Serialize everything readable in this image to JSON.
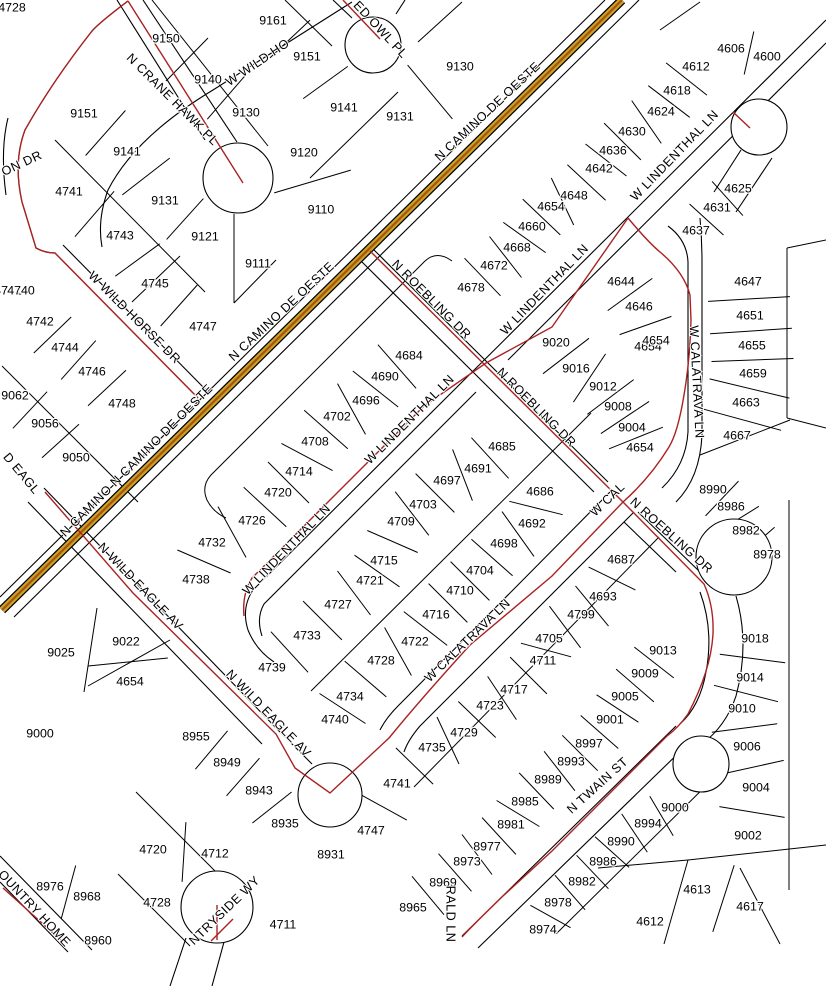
{
  "map": {
    "background": "#ffffff",
    "colors": {
      "parcel_line": "#000000",
      "subdivision_boundary": "#aa2222",
      "highway_outer": "#c9a227",
      "highway_core": "#a85410",
      "label_text": "#000000"
    },
    "highway_name": "N CAMINO DE OESTE",
    "parcel_labels": [
      {
        "t": "4728",
        "x": 12,
        "y": 8
      },
      {
        "t": "9161",
        "x": 273,
        "y": 21
      },
      {
        "t": "9150",
        "x": 166,
        "y": 39
      },
      {
        "t": "9151",
        "x": 307,
        "y": 57
      },
      {
        "t": "9140",
        "x": 208,
        "y": 80
      },
      {
        "t": "9130",
        "x": 460,
        "y": 67
      },
      {
        "t": "9151",
        "x": 84,
        "y": 114
      },
      {
        "t": "9141",
        "x": 344,
        "y": 108
      },
      {
        "t": "9130",
        "x": 246,
        "y": 113
      },
      {
        "t": "9131",
        "x": 400,
        "y": 117
      },
      {
        "t": "9141",
        "x": 127,
        "y": 152
      },
      {
        "t": "9120",
        "x": 304,
        "y": 153
      },
      {
        "t": "4741",
        "x": 69,
        "y": 192
      },
      {
        "t": "9131",
        "x": 165,
        "y": 201
      },
      {
        "t": "9110",
        "x": 321,
        "y": 210
      },
      {
        "t": "9121",
        "x": 205,
        "y": 237
      },
      {
        "t": "4743",
        "x": 120,
        "y": 236
      },
      {
        "t": "9111",
        "x": 258,
        "y": 264
      },
      {
        "t": "4745",
        "x": 155,
        "y": 284
      },
      {
        "t": "4747",
        "x": 203,
        "y": 327
      },
      {
        "t": "4741",
        "x": 8,
        "y": 291
      },
      {
        "t": "4740",
        "x": 21,
        "y": 291
      },
      {
        "t": "4742",
        "x": 40,
        "y": 322
      },
      {
        "t": "4744",
        "x": 65,
        "y": 348
      },
      {
        "t": "4746",
        "x": 92,
        "y": 372
      },
      {
        "t": "4748",
        "x": 122,
        "y": 404
      },
      {
        "t": "9062",
        "x": 15,
        "y": 396
      },
      {
        "t": "9056",
        "x": 45,
        "y": 424
      },
      {
        "t": "9050",
        "x": 76,
        "y": 458
      },
      {
        "t": "4606",
        "x": 731,
        "y": 49
      },
      {
        "t": "4600",
        "x": 767,
        "y": 57
      },
      {
        "t": "4612",
        "x": 696,
        "y": 67
      },
      {
        "t": "4618",
        "x": 677,
        "y": 91
      },
      {
        "t": "4624",
        "x": 661,
        "y": 112
      },
      {
        "t": "4630",
        "x": 632,
        "y": 132
      },
      {
        "t": "4636",
        "x": 613,
        "y": 151
      },
      {
        "t": "4642",
        "x": 599,
        "y": 169
      },
      {
        "t": "4648",
        "x": 574,
        "y": 196
      },
      {
        "t": "4654",
        "x": 551,
        "y": 207
      },
      {
        "t": "4660",
        "x": 532,
        "y": 227
      },
      {
        "t": "4668",
        "x": 517,
        "y": 248
      },
      {
        "t": "4672",
        "x": 494,
        "y": 266
      },
      {
        "t": "4678",
        "x": 471,
        "y": 288
      },
      {
        "t": "4625",
        "x": 738,
        "y": 189
      },
      {
        "t": "4631",
        "x": 717,
        "y": 208
      },
      {
        "t": "4637",
        "x": 696,
        "y": 231
      },
      {
        "t": "4644",
        "x": 621,
        "y": 282
      },
      {
        "t": "4646",
        "x": 639,
        "y": 307
      },
      {
        "t": "4654",
        "x": 648,
        "y": 347
      },
      {
        "t": "4654",
        "x": 656,
        "y": 341
      },
      {
        "t": "9020",
        "x": 556,
        "y": 343
      },
      {
        "t": "9016",
        "x": 576,
        "y": 369
      },
      {
        "t": "9012",
        "x": 603,
        "y": 387
      },
      {
        "t": "9008",
        "x": 618,
        "y": 407
      },
      {
        "t": "9004",
        "x": 632,
        "y": 428
      },
      {
        "t": "4654",
        "x": 640,
        "y": 448
      },
      {
        "t": "4647",
        "x": 748,
        "y": 282
      },
      {
        "t": "4651",
        "x": 750,
        "y": 316
      },
      {
        "t": "4655",
        "x": 752,
        "y": 346
      },
      {
        "t": "4659",
        "x": 753,
        "y": 374
      },
      {
        "t": "4663",
        "x": 746,
        "y": 403
      },
      {
        "t": "4667",
        "x": 737,
        "y": 436
      },
      {
        "t": "8990",
        "x": 713,
        "y": 490
      },
      {
        "t": "8986",
        "x": 731,
        "y": 507
      },
      {
        "t": "8982",
        "x": 746,
        "y": 531
      },
      {
        "t": "8978",
        "x": 767,
        "y": 555
      },
      {
        "t": "4684",
        "x": 409,
        "y": 356
      },
      {
        "t": "4690",
        "x": 385,
        "y": 377
      },
      {
        "t": "4696",
        "x": 366,
        "y": 401
      },
      {
        "t": "4702",
        "x": 337,
        "y": 417
      },
      {
        "t": "4708",
        "x": 315,
        "y": 442
      },
      {
        "t": "4714",
        "x": 299,
        "y": 472
      },
      {
        "t": "4720",
        "x": 278,
        "y": 493
      },
      {
        "t": "4726",
        "x": 252,
        "y": 521
      },
      {
        "t": "4732",
        "x": 212,
        "y": 543
      },
      {
        "t": "4738",
        "x": 196,
        "y": 580
      },
      {
        "t": "4685",
        "x": 502,
        "y": 447
      },
      {
        "t": "4691",
        "x": 478,
        "y": 469
      },
      {
        "t": "4697",
        "x": 447,
        "y": 481
      },
      {
        "t": "4703",
        "x": 423,
        "y": 505
      },
      {
        "t": "4709",
        "x": 401,
        "y": 522
      },
      {
        "t": "4715",
        "x": 384,
        "y": 561
      },
      {
        "t": "4721",
        "x": 370,
        "y": 581
      },
      {
        "t": "4727",
        "x": 338,
        "y": 605
      },
      {
        "t": "4733",
        "x": 307,
        "y": 636
      },
      {
        "t": "4739",
        "x": 272,
        "y": 668
      },
      {
        "t": "4686",
        "x": 540,
        "y": 492
      },
      {
        "t": "4692",
        "x": 532,
        "y": 524
      },
      {
        "t": "4698",
        "x": 504,
        "y": 544
      },
      {
        "t": "4704",
        "x": 480,
        "y": 571
      },
      {
        "t": "4710",
        "x": 460,
        "y": 591
      },
      {
        "t": "4716",
        "x": 436,
        "y": 615
      },
      {
        "t": "4722",
        "x": 415,
        "y": 642
      },
      {
        "t": "4728",
        "x": 381,
        "y": 661
      },
      {
        "t": "4734",
        "x": 350,
        "y": 697
      },
      {
        "t": "4740",
        "x": 335,
        "y": 720
      },
      {
        "t": "9025",
        "x": 61,
        "y": 653
      },
      {
        "t": "9022",
        "x": 126,
        "y": 642
      },
      {
        "t": "4654",
        "x": 130,
        "y": 682
      },
      {
        "t": "9000",
        "x": 40,
        "y": 734
      },
      {
        "t": "8955",
        "x": 196,
        "y": 737
      },
      {
        "t": "8949",
        "x": 227,
        "y": 763
      },
      {
        "t": "8943",
        "x": 259,
        "y": 791
      },
      {
        "t": "8935",
        "x": 285,
        "y": 824
      },
      {
        "t": "8931",
        "x": 331,
        "y": 855
      },
      {
        "t": "4720",
        "x": 153,
        "y": 850
      },
      {
        "t": "4712",
        "x": 215,
        "y": 854
      },
      {
        "t": "4728",
        "x": 157,
        "y": 903
      },
      {
        "t": "4711",
        "x": 283,
        "y": 925
      },
      {
        "t": "8976",
        "x": 50,
        "y": 887
      },
      {
        "t": "8968",
        "x": 87,
        "y": 897
      },
      {
        "t": "8960",
        "x": 98,
        "y": 941
      },
      {
        "t": "4741",
        "x": 397,
        "y": 784
      },
      {
        "t": "4747",
        "x": 371,
        "y": 831
      },
      {
        "t": "4735",
        "x": 432,
        "y": 748
      },
      {
        "t": "4729",
        "x": 464,
        "y": 733
      },
      {
        "t": "4723",
        "x": 490,
        "y": 706
      },
      {
        "t": "4717",
        "x": 514,
        "y": 690
      },
      {
        "t": "4711",
        "x": 543,
        "y": 661
      },
      {
        "t": "4705",
        "x": 549,
        "y": 639
      },
      {
        "t": "4799",
        "x": 581,
        "y": 615
      },
      {
        "t": "4693",
        "x": 603,
        "y": 597
      },
      {
        "t": "4687",
        "x": 621,
        "y": 560
      },
      {
        "t": "9013",
        "x": 663,
        "y": 651
      },
      {
        "t": "9009",
        "x": 645,
        "y": 674
      },
      {
        "t": "9005",
        "x": 625,
        "y": 697
      },
      {
        "t": "9001",
        "x": 610,
        "y": 720
      },
      {
        "t": "8997",
        "x": 589,
        "y": 744
      },
      {
        "t": "8993",
        "x": 571,
        "y": 762
      },
      {
        "t": "8989",
        "x": 548,
        "y": 780
      },
      {
        "t": "8985",
        "x": 525,
        "y": 802
      },
      {
        "t": "8981",
        "x": 511,
        "y": 825
      },
      {
        "t": "8977",
        "x": 487,
        "y": 847
      },
      {
        "t": "8973",
        "x": 467,
        "y": 862
      },
      {
        "t": "8969",
        "x": 443,
        "y": 883
      },
      {
        "t": "8965",
        "x": 413,
        "y": 908
      },
      {
        "t": "8974",
        "x": 543,
        "y": 930
      },
      {
        "t": "8978",
        "x": 558,
        "y": 903
      },
      {
        "t": "8982",
        "x": 582,
        "y": 882
      },
      {
        "t": "8986",
        "x": 603,
        "y": 862
      },
      {
        "t": "8990",
        "x": 621,
        "y": 842
      },
      {
        "t": "8994",
        "x": 648,
        "y": 824
      },
      {
        "t": "9000",
        "x": 675,
        "y": 808
      },
      {
        "t": "9018",
        "x": 755,
        "y": 639
      },
      {
        "t": "9014",
        "x": 750,
        "y": 678
      },
      {
        "t": "9010",
        "x": 742,
        "y": 709
      },
      {
        "t": "9006",
        "x": 747,
        "y": 747
      },
      {
        "t": "9004",
        "x": 756,
        "y": 788
      },
      {
        "t": "9002",
        "x": 748,
        "y": 836
      },
      {
        "t": "4613",
        "x": 697,
        "y": 890
      },
      {
        "t": "4617",
        "x": 750,
        "y": 907
      },
      {
        "t": "4612",
        "x": 650,
        "y": 922
      }
    ],
    "street_labels": [
      {
        "t": "W WILD HO",
        "x": 258,
        "y": 63,
        "r": -34
      },
      {
        "t": "N CRANE HAWK PL",
        "x": 172,
        "y": 100,
        "r": 45
      },
      {
        "t": "ED OWL PL",
        "x": 380,
        "y": 30,
        "r": 47
      },
      {
        "t": "N CAMINO DE OESTE",
        "x": 488,
        "y": 112,
        "r": -43
      },
      {
        "t": "N CAMINO DE OESTE",
        "x": 282,
        "y": 312,
        "r": -43
      },
      {
        "t": "N CAMINO N CAMINO DE OESTE",
        "x": 137,
        "y": 461,
        "r": -45
      },
      {
        "t": "W WILD HORSE DR",
        "x": 134,
        "y": 318,
        "r": 45
      },
      {
        "t": "N ROEBLING DR",
        "x": 431,
        "y": 300,
        "r": 45
      },
      {
        "t": "N ROEBLING DR",
        "x": 536,
        "y": 408,
        "r": 45
      },
      {
        "t": "N ROEBLING DR",
        "x": 671,
        "y": 536,
        "r": 42
      },
      {
        "t": "W LINDENTHAL LN",
        "x": 675,
        "y": 156,
        "r": -46
      },
      {
        "t": "W LINDENTHAL LN",
        "x": 545,
        "y": 290,
        "r": -46
      },
      {
        "t": "W LINDENTHAL LN",
        "x": 410,
        "y": 420,
        "r": -45
      },
      {
        "t": "W LINDENTHAL LN",
        "x": 287,
        "y": 550,
        "r": -46
      },
      {
        "t": "W CALATRAVA LN",
        "x": 696,
        "y": 382,
        "r": 87
      },
      {
        "t": "W CALATRAVA LN",
        "x": 468,
        "y": 641,
        "r": -44
      },
      {
        "t": "W CAL",
        "x": 608,
        "y": 500,
        "r": -44
      },
      {
        "t": "N WILD EAGLE AV",
        "x": 140,
        "y": 587,
        "r": 46
      },
      {
        "t": "N WILD EAGLE AV",
        "x": 268,
        "y": 714,
        "r": 46
      },
      {
        "t": "N TWAIN ST",
        "x": 598,
        "y": 786,
        "r": -42
      },
      {
        "t": "RALD LN",
        "x": 450,
        "y": 914,
        "r": 90
      },
      {
        "t": "NTRYSIDE WY",
        "x": 225,
        "y": 911,
        "r": -44
      },
      {
        "t": "OUNTRY HOME",
        "x": 34,
        "y": 909,
        "r": 47
      },
      {
        "t": "ON DR",
        "x": 22,
        "y": 164,
        "r": -25
      },
      {
        "t": "D EAGL",
        "x": 21,
        "y": 474,
        "r": 50
      }
    ]
  }
}
